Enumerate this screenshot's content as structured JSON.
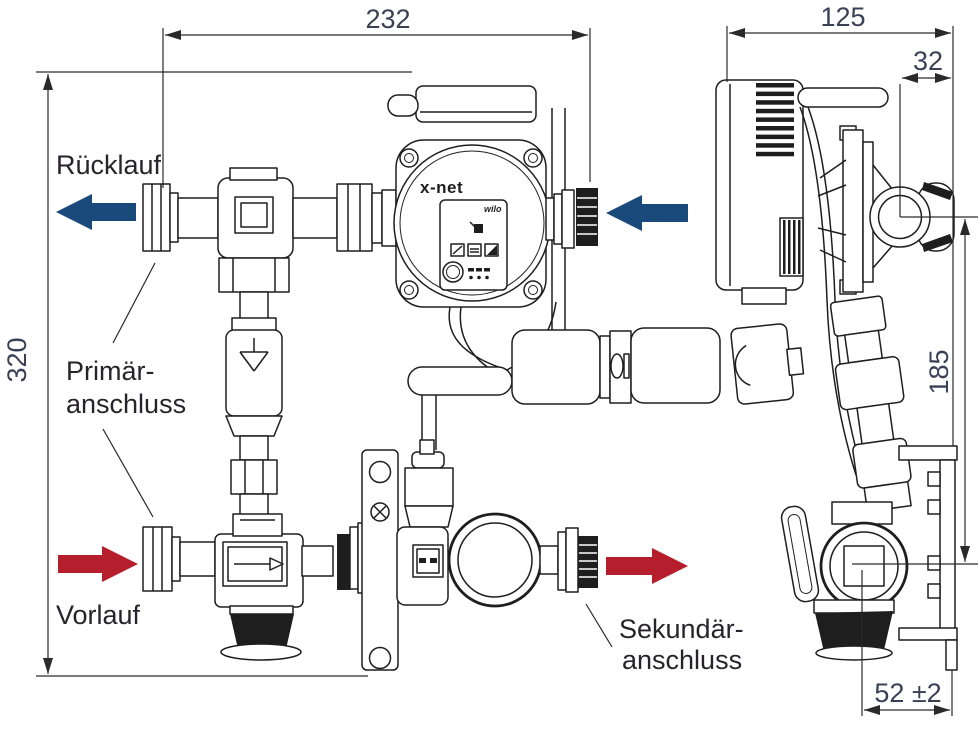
{
  "diagram": {
    "type": "technical dimension drawing",
    "product": "x-net heating circuit pump group, front and side view",
    "labels": {
      "ruecklauf": "Rücklauf",
      "primaer_line1": "Primär-",
      "primaer_line2": "anschluss",
      "vorlauf": "Vorlauf",
      "sekundaer_line1": "Sekundär-",
      "sekundaer_line2": "anschluss"
    },
    "dimensions_mm": {
      "overall_width_front": "232",
      "overall_height_front": "320",
      "overall_depth_side": "125",
      "port_offset_depth": "32",
      "port_height_span": "185",
      "knob_to_wall": "52 ±2"
    },
    "pump": {
      "brand": "x-net",
      "logo": "wilo"
    },
    "colors": {
      "return_flow_arrow": "#1a4a7b",
      "supply_flow_arrow": "#b51e2c",
      "dimension_text": "#3a4156",
      "label_text": "#27232b",
      "drawing_line": "#1e1e1e",
      "background": "#ffffff"
    }
  }
}
